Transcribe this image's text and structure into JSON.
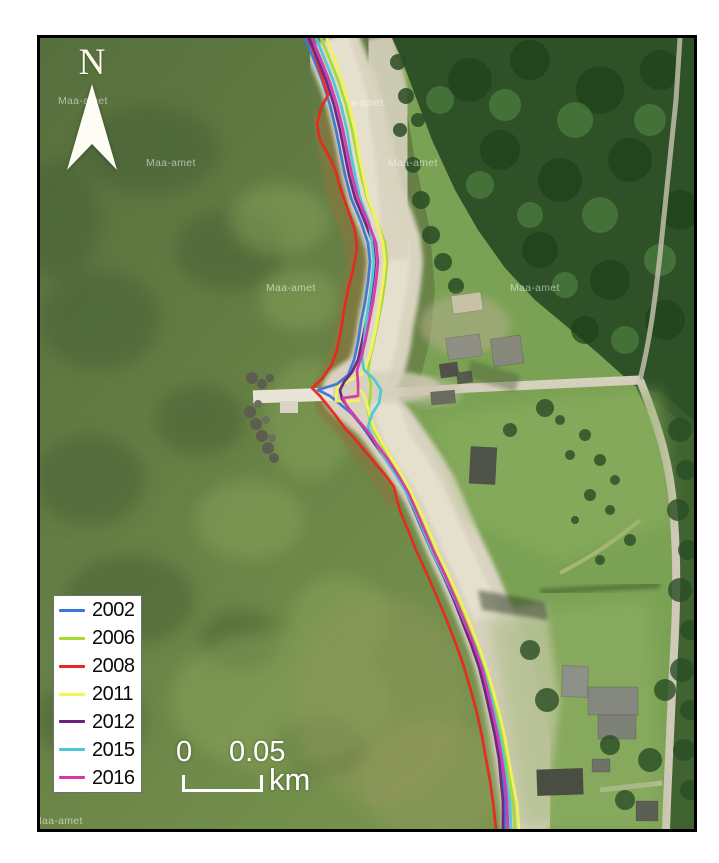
{
  "north": {
    "label": "N"
  },
  "legend": {
    "items": [
      {
        "label": "2002",
        "color": "#3a76d8"
      },
      {
        "label": "2006",
        "color": "#a4d934"
      },
      {
        "label": "2008",
        "color": "#e8281e"
      },
      {
        "label": "2011",
        "color": "#f4f455"
      },
      {
        "label": "2012",
        "color": "#67217e"
      },
      {
        "label": "2015",
        "color": "#46c8d8"
      },
      {
        "label": "2016",
        "color": "#d434ae"
      }
    ]
  },
  "scale_bar": {
    "label_start": "0",
    "label_end": "0.05",
    "unit": "km"
  },
  "map": {
    "watermark_text": "Maa-amet",
    "watermarks": [
      [
        58,
        104
      ],
      [
        146,
        166
      ],
      [
        334,
        106
      ],
      [
        388,
        166
      ],
      [
        266,
        291
      ],
      [
        510,
        291
      ],
      [
        33,
        824
      ]
    ],
    "shorelines": [
      {
        "year": "2002",
        "color": "#3a76d8",
        "points": [
          [
            305,
            38
          ],
          [
            312,
            55
          ],
          [
            322,
            80
          ],
          [
            330,
            105
          ],
          [
            336,
            130
          ],
          [
            341,
            155
          ],
          [
            345,
            175
          ],
          [
            351,
            198
          ],
          [
            361,
            222
          ],
          [
            368,
            243
          ],
          [
            370,
            262
          ],
          [
            368,
            282
          ],
          [
            365,
            302
          ],
          [
            361,
            322
          ],
          [
            358,
            342
          ],
          [
            354,
            360
          ],
          [
            348,
            375
          ],
          [
            337,
            384
          ],
          [
            318,
            390
          ],
          [
            330,
            396
          ],
          [
            340,
            404
          ],
          [
            352,
            414
          ],
          [
            362,
            426
          ],
          [
            372,
            440
          ],
          [
            382,
            454
          ],
          [
            394,
            472
          ],
          [
            405,
            490
          ],
          [
            413,
            508
          ],
          [
            421,
            527
          ],
          [
            431,
            550
          ],
          [
            442,
            573
          ],
          [
            452,
            596
          ],
          [
            462,
            620
          ],
          [
            471,
            643
          ],
          [
            479,
            666
          ],
          [
            486,
            690
          ],
          [
            491,
            712
          ],
          [
            496,
            735
          ],
          [
            500,
            758
          ],
          [
            503,
            780
          ],
          [
            505,
            800
          ],
          [
            505,
            829
          ]
        ]
      },
      {
        "year": "2006",
        "color": "#a4d934",
        "points": [
          [
            321,
            38
          ],
          [
            328,
            55
          ],
          [
            338,
            80
          ],
          [
            346,
            105
          ],
          [
            352,
            130
          ],
          [
            357,
            155
          ],
          [
            361,
            175
          ],
          [
            367,
            198
          ],
          [
            377,
            222
          ],
          [
            385,
            243
          ],
          [
            387,
            262
          ],
          [
            385,
            282
          ],
          [
            382,
            302
          ],
          [
            378,
            322
          ],
          [
            374,
            342
          ],
          [
            370,
            358
          ],
          [
            368,
            372
          ],
          [
            371,
            384
          ],
          [
            370,
            398
          ],
          [
            368,
            410
          ],
          [
            370,
            422
          ],
          [
            375,
            433
          ],
          [
            383,
            447
          ],
          [
            392,
            461
          ],
          [
            402,
            477
          ],
          [
            411,
            493
          ],
          [
            419,
            511
          ],
          [
            427,
            530
          ],
          [
            437,
            553
          ],
          [
            448,
            576
          ],
          [
            458,
            599
          ],
          [
            468,
            623
          ],
          [
            477,
            646
          ],
          [
            485,
            669
          ],
          [
            491,
            693
          ],
          [
            497,
            715
          ],
          [
            502,
            738
          ],
          [
            506,
            760
          ],
          [
            510,
            782
          ],
          [
            513,
            802
          ],
          [
            515,
            829
          ]
        ]
      },
      {
        "year": "2008",
        "color": "#e8281e",
        "points": [
          [
            308,
            38
          ],
          [
            315,
            55
          ],
          [
            323,
            80
          ],
          [
            328,
            95
          ],
          [
            321,
            108
          ],
          [
            317,
            124
          ],
          [
            320,
            140
          ],
          [
            330,
            158
          ],
          [
            336,
            172
          ],
          [
            341,
            190
          ],
          [
            348,
            210
          ],
          [
            355,
            230
          ],
          [
            357,
            250
          ],
          [
            353,
            270
          ],
          [
            348,
            290
          ],
          [
            344,
            310
          ],
          [
            341,
            330
          ],
          [
            337,
            350
          ],
          [
            331,
            366
          ],
          [
            322,
            379
          ],
          [
            312,
            388
          ],
          [
            320,
            396
          ],
          [
            328,
            406
          ],
          [
            336,
            416
          ],
          [
            344,
            427
          ],
          [
            354,
            438
          ],
          [
            365,
            451
          ],
          [
            375,
            463
          ],
          [
            386,
            476
          ],
          [
            394,
            487
          ],
          [
            397,
            500
          ],
          [
            400,
            511
          ],
          [
            408,
            530
          ],
          [
            416,
            550
          ],
          [
            427,
            574
          ],
          [
            437,
            597
          ],
          [
            447,
            621
          ],
          [
            456,
            644
          ],
          [
            464,
            667
          ],
          [
            471,
            691
          ],
          [
            477,
            713
          ],
          [
            482,
            736
          ],
          [
            486,
            759
          ],
          [
            490,
            781
          ],
          [
            493,
            802
          ],
          [
            496,
            829
          ]
        ]
      },
      {
        "year": "2011",
        "color": "#f4f455",
        "points": [
          [
            327,
            38
          ],
          [
            333,
            55
          ],
          [
            342,
            80
          ],
          [
            349,
            105
          ],
          [
            355,
            130
          ],
          [
            359,
            155
          ],
          [
            363,
            175
          ],
          [
            368,
            198
          ],
          [
            377,
            222
          ],
          [
            383,
            243
          ],
          [
            385,
            262
          ],
          [
            383,
            282
          ],
          [
            380,
            302
          ],
          [
            377,
            322
          ],
          [
            373,
            342
          ],
          [
            369,
            358
          ],
          [
            362,
            374
          ],
          [
            344,
            383
          ],
          [
            337,
            388
          ],
          [
            336,
            401
          ],
          [
            358,
            401
          ],
          [
            357,
            388
          ],
          [
            363,
            393
          ],
          [
            367,
            404
          ],
          [
            370,
            416
          ],
          [
            374,
            428
          ],
          [
            381,
            441
          ],
          [
            390,
            456
          ],
          [
            400,
            472
          ],
          [
            410,
            490
          ],
          [
            419,
            509
          ],
          [
            428,
            529
          ],
          [
            438,
            553
          ],
          [
            449,
            576
          ],
          [
            460,
            600
          ],
          [
            470,
            624
          ],
          [
            479,
            647
          ],
          [
            487,
            670
          ],
          [
            494,
            694
          ],
          [
            500,
            716
          ],
          [
            505,
            738
          ],
          [
            509,
            761
          ],
          [
            513,
            783
          ],
          [
            517,
            803
          ],
          [
            519,
            829
          ]
        ]
      },
      {
        "year": "2012",
        "color": "#67217e",
        "points": [
          [
            309,
            38
          ],
          [
            316,
            55
          ],
          [
            326,
            80
          ],
          [
            334,
            105
          ],
          [
            340,
            130
          ],
          [
            345,
            155
          ],
          [
            349,
            175
          ],
          [
            355,
            198
          ],
          [
            365,
            222
          ],
          [
            373,
            243
          ],
          [
            375,
            262
          ],
          [
            373,
            282
          ],
          [
            370,
            302
          ],
          [
            366,
            322
          ],
          [
            362,
            342
          ],
          [
            358,
            360
          ],
          [
            352,
            372
          ],
          [
            344,
            382
          ],
          [
            340,
            390
          ],
          [
            342,
            399
          ],
          [
            349,
            409
          ],
          [
            357,
            419
          ],
          [
            366,
            430
          ],
          [
            375,
            444
          ],
          [
            385,
            458
          ],
          [
            396,
            474
          ],
          [
            406,
            491
          ],
          [
            414,
            509
          ],
          [
            422,
            528
          ],
          [
            432,
            551
          ],
          [
            443,
            574
          ],
          [
            453,
            597
          ],
          [
            462,
            621
          ],
          [
            471,
            644
          ],
          [
            479,
            667
          ],
          [
            485,
            691
          ],
          [
            490,
            713
          ],
          [
            495,
            736
          ],
          [
            499,
            759
          ],
          [
            501,
            781
          ],
          [
            503,
            801
          ],
          [
            503,
            829
          ]
        ]
      },
      {
        "year": "2015",
        "color": "#46c8d8",
        "points": [
          [
            316,
            38
          ],
          [
            323,
            55
          ],
          [
            333,
            80
          ],
          [
            341,
            105
          ],
          [
            347,
            130
          ],
          [
            351,
            155
          ],
          [
            355,
            175
          ],
          [
            360,
            198
          ],
          [
            369,
            222
          ],
          [
            372,
            243
          ],
          [
            374,
            262
          ],
          [
            372,
            282
          ],
          [
            369,
            302
          ],
          [
            366,
            322
          ],
          [
            364,
            342
          ],
          [
            362,
            358
          ],
          [
            364,
            370
          ],
          [
            374,
            379
          ],
          [
            381,
            390
          ],
          [
            379,
            403
          ],
          [
            372,
            414
          ],
          [
            368,
            427
          ],
          [
            374,
            440
          ],
          [
            383,
            455
          ],
          [
            394,
            472
          ],
          [
            405,
            490
          ],
          [
            414,
            508
          ],
          [
            422,
            527
          ],
          [
            432,
            551
          ],
          [
            444,
            575
          ],
          [
            455,
            599
          ],
          [
            465,
            623
          ],
          [
            475,
            646
          ],
          [
            483,
            669
          ],
          [
            490,
            693
          ],
          [
            495,
            715
          ],
          [
            500,
            738
          ],
          [
            504,
            760
          ],
          [
            507,
            782
          ],
          [
            510,
            802
          ],
          [
            511,
            829
          ]
        ]
      },
      {
        "year": "2016",
        "color": "#d434ae",
        "points": [
          [
            312,
            38
          ],
          [
            319,
            55
          ],
          [
            329,
            80
          ],
          [
            337,
            105
          ],
          [
            343,
            130
          ],
          [
            348,
            155
          ],
          [
            352,
            175
          ],
          [
            358,
            198
          ],
          [
            368,
            222
          ],
          [
            376,
            243
          ],
          [
            378,
            262
          ],
          [
            376,
            282
          ],
          [
            373,
            302
          ],
          [
            369,
            322
          ],
          [
            365,
            342
          ],
          [
            361,
            358
          ],
          [
            357,
            370
          ],
          [
            358,
            383
          ],
          [
            358,
            396
          ],
          [
            343,
            398
          ],
          [
            347,
            407
          ],
          [
            355,
            417
          ],
          [
            365,
            428
          ],
          [
            376,
            443
          ],
          [
            387,
            458
          ],
          [
            398,
            475
          ],
          [
            408,
            492
          ],
          [
            416,
            510
          ],
          [
            424,
            529
          ],
          [
            434,
            552
          ],
          [
            445,
            575
          ],
          [
            455,
            598
          ],
          [
            465,
            622
          ],
          [
            474,
            645
          ],
          [
            482,
            668
          ],
          [
            488,
            692
          ],
          [
            493,
            714
          ],
          [
            498,
            737
          ],
          [
            502,
            760
          ],
          [
            505,
            782
          ],
          [
            507,
            802
          ],
          [
            508,
            829
          ]
        ]
      }
    ]
  }
}
